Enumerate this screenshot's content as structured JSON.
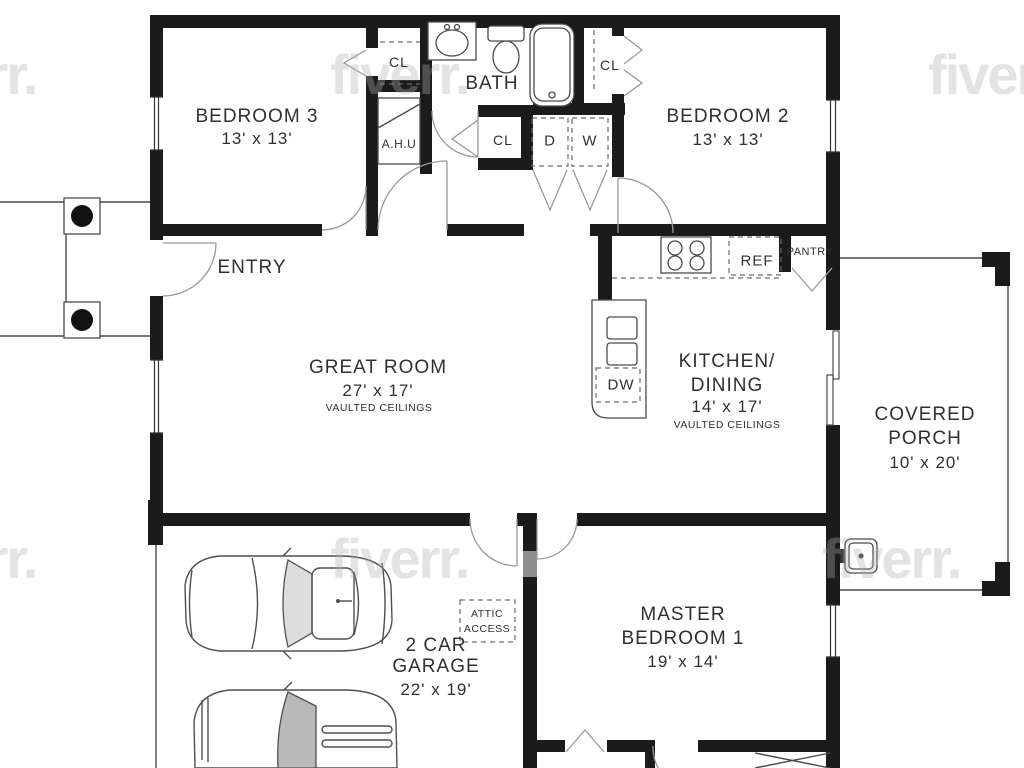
{
  "watermark": {
    "text": "fiverr."
  },
  "rooms": {
    "bedroom3": {
      "name": "BEDROOM 3",
      "dims": "13' x 13'"
    },
    "bath": {
      "name": "BATH"
    },
    "bedroom2": {
      "name": "BEDROOM 2",
      "dims": "13' x 13'"
    },
    "entry": {
      "name": "ENTRY"
    },
    "great_room": {
      "name": "GREAT ROOM",
      "dims": "27' x 17'",
      "note": "VAULTED CEILINGS"
    },
    "kitchen": {
      "name_line1": "KITCHEN/",
      "name_line2": "DINING",
      "dims": "14' x 17'",
      "note": "VAULTED CEILINGS"
    },
    "porch": {
      "name_line1": "COVERED",
      "name_line2": "PORCH",
      "dims": "10' x 20'"
    },
    "garage": {
      "name_line1": "2 CAR",
      "name_line2": "GARAGE",
      "dims": "22' x 19'"
    },
    "master": {
      "name_line1": "MASTER",
      "name_line2": "BEDROOM 1",
      "dims": "19' x 14'"
    },
    "attic": {
      "line1": "ATTIC",
      "line2": "ACCESS"
    }
  },
  "fixtures": {
    "closet": "CL",
    "air_handler": "A.H.U",
    "dryer": "D",
    "washer": "W",
    "pantry": "PANTRY",
    "refrigerator": "REF",
    "dishwasher": "DW"
  }
}
